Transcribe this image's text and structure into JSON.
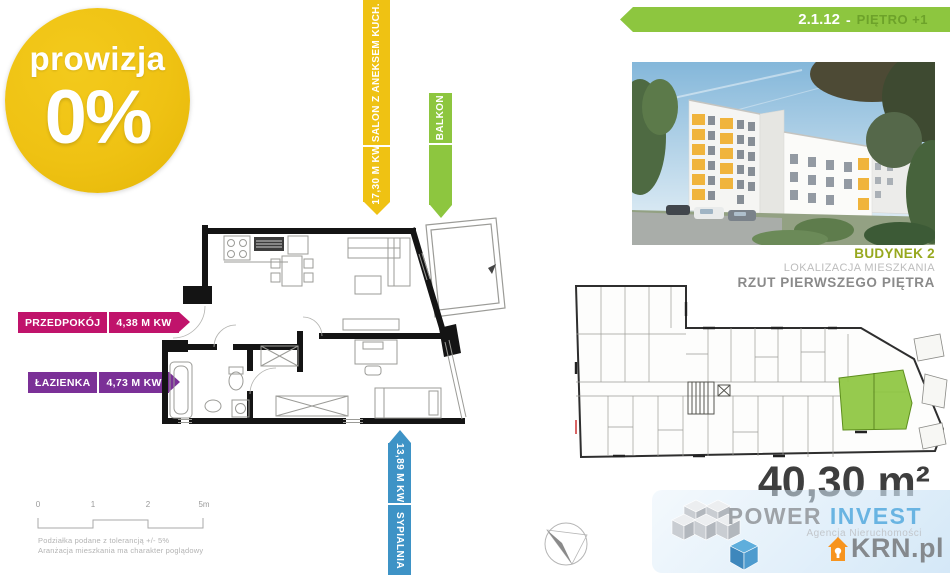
{
  "badge": {
    "top": "prowizja",
    "bottom": "0%"
  },
  "unit_banner": {
    "number": "2.1.12",
    "separator": "-",
    "floor": "PIĘTRO +1"
  },
  "room_labels": {
    "salon": {
      "name": "SALON Z ANEKSEM KUCH.",
      "area": "17,30 M KW"
    },
    "balkon": {
      "name": "BALKON"
    },
    "przedpokoj": {
      "name": "PRZEDPOKÓJ",
      "area": "4,38 M KW"
    },
    "lazienka": {
      "name": "ŁAZIENKA",
      "area": "4,73 M KW"
    },
    "sypialnia": {
      "name": "SYPIALNIA",
      "area": "13,89 M KW"
    }
  },
  "building_info": {
    "name": "BUDYNEK 2",
    "location_label": "LOKALIZACJA MIESZKANIA",
    "plan_title": "RZUT PIERWSZEGO PIĘTRA"
  },
  "total_area": "40,30 m²",
  "scale_bar": {
    "ticks": [
      "0",
      "1",
      "2",
      "5m"
    ],
    "note_line1": "Podziałka podane z tolerancją +/- 5%",
    "note_line2": "Aranżacja mieszkania ma charakter poglądowy"
  },
  "branding": {
    "brand_word1": "POWER",
    "brand_word2": "INVEST",
    "tagline": "Agencja Nieruchomości",
    "watermark": "KRN.pl"
  },
  "colors": {
    "yellow": "#EFC213",
    "green": "#8DC63F",
    "green_dark": "#6DA22A",
    "magenta": "#C0136B",
    "purple": "#7B3097",
    "blue": "#3E93C6",
    "olive_text": "#97A81E",
    "area_text": "#3E3E3E",
    "brand_gray": "#9EA3A8",
    "brand_blue": "#69B4E2",
    "krn_orange": "#F7941E"
  }
}
